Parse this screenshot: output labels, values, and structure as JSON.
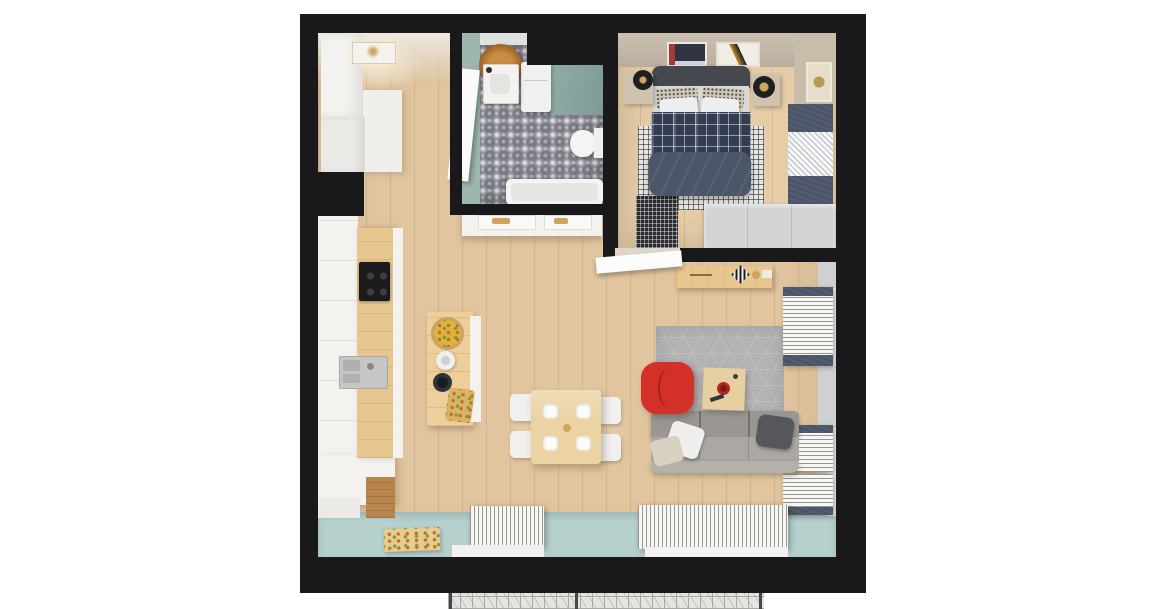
{
  "scene": {
    "description": "top-down 3d render of a studio apartment floor plan on white background",
    "background": "#ffffff"
  },
  "palette": {
    "wall": "#19191b",
    "wood": "#e0c59e",
    "wood-line": "rgba(125,90,50,0.16)",
    "wood-bed": "#e6cda8",
    "beige-wall": "#cbc0b1",
    "beige-wall2": "#c8bcab",
    "teal-wall": "#9db7af",
    "teal-wall2": "#8fada6",
    "tile": "#90909a",
    "balcony": "#b5d0cd",
    "white-f": "#f3f2ef",
    "white-soft": "#eceae6",
    "counter-wood": "#e7c78f",
    "island-wood": "#eccf9b",
    "dark-wood": "#b9854e",
    "cooktop": "#1b1b1d",
    "steel": "#c6c7c5",
    "rug": "#b3b2b4",
    "red": "#d23028",
    "red-deep": "#a8201c",
    "sofa": "#9a9793",
    "sofa-seat": "#aba8a4",
    "pillow-w": "#f0efed",
    "pillow-b": "#d8d1c2",
    "pillow-d": "#55575b",
    "coffee": "#e6cfa0",
    "table": "#ebd3a3",
    "chair": "#f1f0ee",
    "headboard": "#45484f",
    "plaid": "#333c50",
    "duvet": "#4b5669",
    "check": "#e7e6e1",
    "nightstand": "#cfc3ae",
    "lamp": "#1f1f22",
    "gold": "#cfa45c",
    "wardrobe": "#d2d3d5",
    "curtain": "#f6f6f5",
    "curtain-line": "#97978f",
    "curtain-dark": "#4a5365",
    "gray-wall": "#cfd0d2",
    "mesh": "#e4e4e1",
    "mesh-line": "#a9a9a4",
    "glow": "rgba(255,241,214,0.55)"
  },
  "apartment": {
    "rooms": [
      {
        "id": "entry-hall",
        "furniture": [
          "white-wardrobe",
          "ceiling-lamp"
        ]
      },
      {
        "id": "kitchen",
        "furniture": [
          "cabinet-run",
          "wood-counter",
          "cooktop",
          "sink",
          "lower-cabinets",
          "kitchen-island",
          "fruit-bowl",
          "kettle",
          "dark-bowl",
          "cutting-board"
        ]
      },
      {
        "id": "bathroom",
        "furniture": [
          "wooden-vanity-stool",
          "washbasin",
          "entry-door",
          "washing-machine",
          "shower-panel",
          "toilet",
          "bathtub"
        ]
      },
      {
        "id": "bedroom",
        "furniture": [
          "double-bed",
          "headboard",
          "plaid-blanket",
          "duvet",
          "pillows",
          "checkered-rug",
          "nightstand-left",
          "nightstand-right",
          "bedside-lamps",
          "wall-art-1",
          "wall-art-2",
          "wall-art-side",
          "window-curtains",
          "wardrobe",
          "floor-grille",
          "door-leaf"
        ]
      },
      {
        "id": "inner-hallway",
        "furniture": [
          "wooden-console",
          "clock",
          "decor-items",
          "white-sideboard"
        ]
      },
      {
        "id": "living-room",
        "furniture": [
          "hex-rug",
          "red-armchair",
          "coffee-table",
          "sofa",
          "throw-pillows",
          "dining-table",
          "dining-chairs",
          "plates",
          "side-curtains"
        ]
      },
      {
        "id": "balcony-edge",
        "furniture": [
          "teal-floor",
          "wooden-tray",
          "bunched-curtains-left",
          "bunched-curtains-right",
          "railing-mesh"
        ]
      }
    ]
  }
}
